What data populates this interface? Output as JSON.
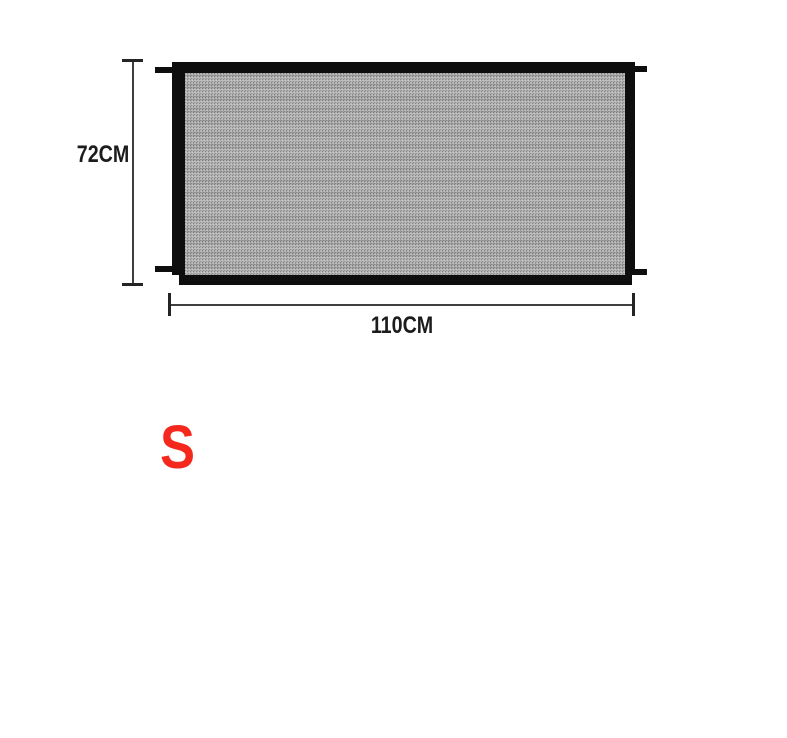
{
  "figure": {
    "name": "mesh-gate-size-diagram",
    "height_dimension": {
      "label": "72CM"
    },
    "width_dimension": {
      "label": "110CM"
    },
    "size_variant": {
      "label": "S"
    }
  },
  "colors": {
    "background": "#ffffff",
    "gate_frame": "#0e0e0e",
    "gate_mesh": "#a6a6a6",
    "dimension_line": "#3f3f3f",
    "dimension_text": "#1c1c1c",
    "size_letter": "#f5281e"
  }
}
